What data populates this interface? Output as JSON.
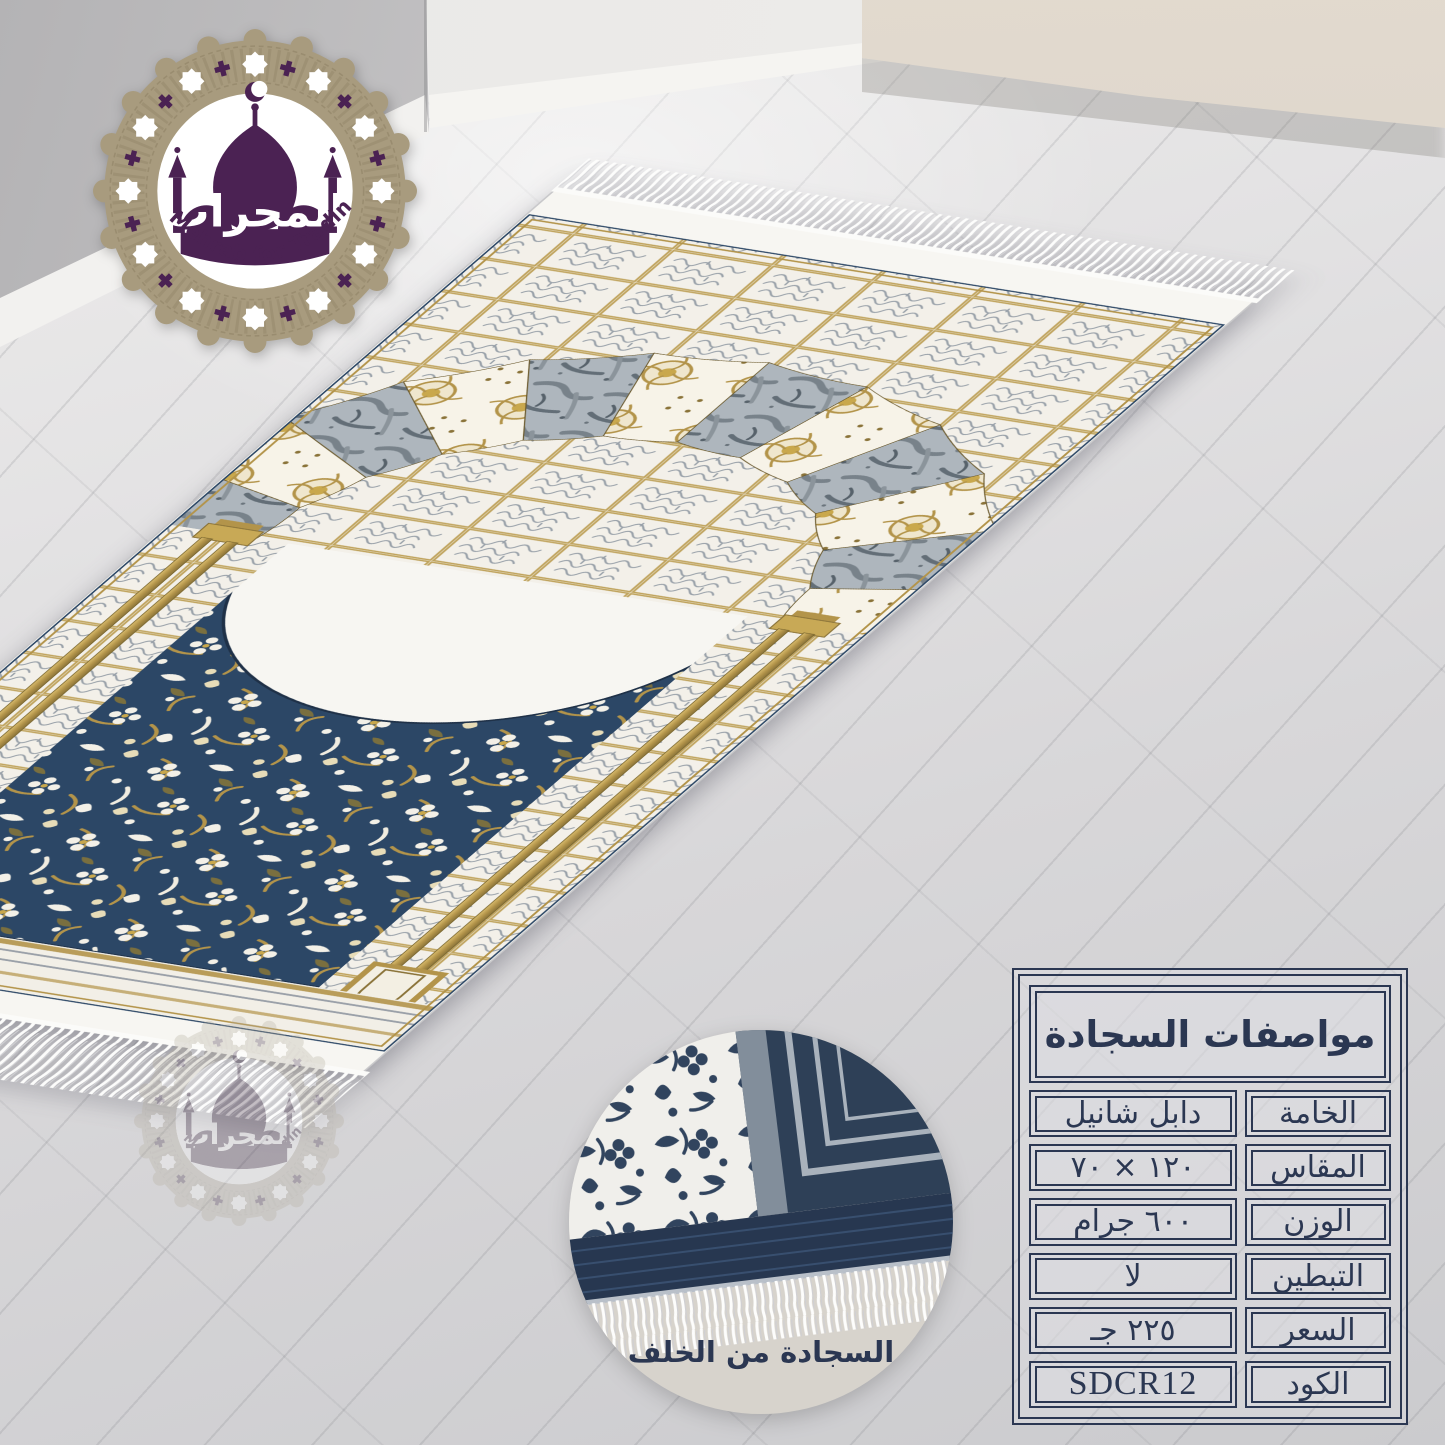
{
  "brand_logo": {
    "arabic_name": "المحراب",
    "tagline": "Al Mehrab for Trading"
  },
  "back_view_inset": {
    "caption": "السجادة من الخلف"
  },
  "spec_table": {
    "title": "مواصفات السجادة",
    "rows": [
      {
        "label": "الخامة",
        "value": "دابل شانيل"
      },
      {
        "label": "المقاس",
        "value": "١٢٠ × ٧٠"
      },
      {
        "label": "الوزن",
        "value": "٦٠٠ جرام"
      },
      {
        "label": "التبطين",
        "value": "لا"
      },
      {
        "label": "السعر",
        "value": "٢٢٥ جـ"
      },
      {
        "label": "الكود",
        "value": "SDCR12"
      }
    ]
  },
  "colors": {
    "navy_border": "#2b3752",
    "rug_field_navy": "#2c4766",
    "rug_gold": "#b3944a",
    "logo_purple": "#4b2253",
    "logo_tan": "#a89b7e",
    "fringe_white": "#fbfbfa",
    "floor_grey": "#d8d7d9",
    "bench_beige": "#dbd3c8",
    "inset_background": "#d7d3cc"
  }
}
